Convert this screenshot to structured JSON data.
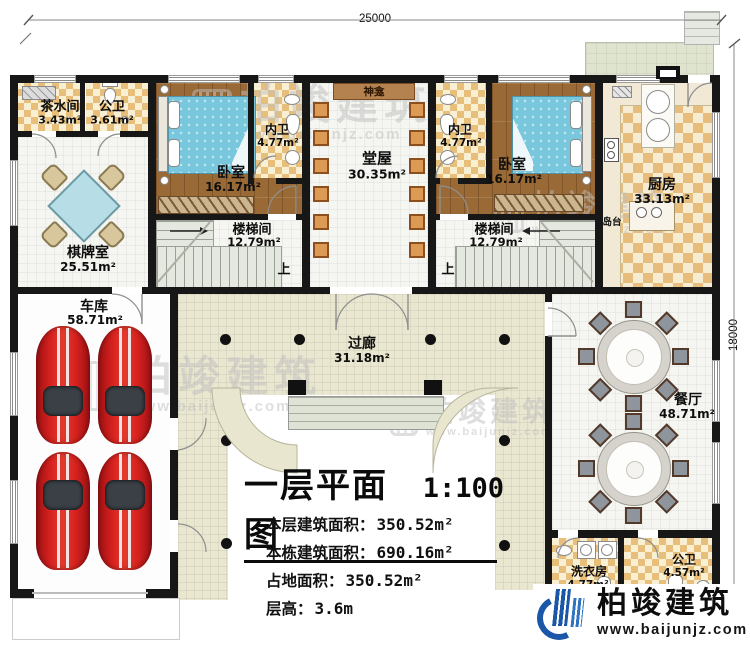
{
  "plan": {
    "dimension_top": "25000",
    "dimension_right": "18000"
  },
  "rooms": {
    "tea": {
      "name": "茶水间",
      "area": "3.43m²"
    },
    "pubwc_top": {
      "name": "公卫",
      "area": "3.61m²"
    },
    "chess": {
      "name": "棋牌室",
      "area": "25.51m²"
    },
    "bed_left": {
      "name": "卧室",
      "area": "16.17m²"
    },
    "bath_left": {
      "name": "内卫",
      "area": "4.77m²"
    },
    "hall": {
      "name": "堂屋",
      "area": "30.35m²"
    },
    "bath_right": {
      "name": "内卫",
      "area": "4.77m²"
    },
    "bed_right": {
      "name": "卧室",
      "area": "16.17m²"
    },
    "kitchen": {
      "name": "厨房",
      "area": "33.13m²"
    },
    "stair_left": {
      "name": "楼梯间",
      "area": "12.79m²"
    },
    "stair_right": {
      "name": "楼梯间",
      "area": "12.79m²"
    },
    "garage": {
      "name": "车库",
      "area": "58.71m²"
    },
    "corridor": {
      "name": "过廊",
      "area": "31.18m²"
    },
    "dining": {
      "name": "餐厅",
      "area": "48.71m²"
    },
    "laundry": {
      "name": "洗衣房",
      "area": "4.77m²"
    },
    "pubwc_bottom": {
      "name": "公卫",
      "area": "4.57m²"
    }
  },
  "annotations": {
    "shrine": "神龛",
    "island": "岛台",
    "stairs_up": "上"
  },
  "title_block": {
    "title": "一层平面图",
    "scale": "1:100",
    "rows": [
      {
        "label": "本层建筑面积：",
        "value": "350.52m²"
      },
      {
        "label": "本栋建筑面积：",
        "value": "690.16m²"
      },
      {
        "label": "占地面积：",
        "value": "350.52m²"
      },
      {
        "label": "层高：",
        "value": "3.6m"
      }
    ]
  },
  "branding": {
    "name": "柏竣建筑",
    "website": "www.baijunjz.com"
  },
  "colors": {
    "wall": "#171717",
    "checker_dark": "#e8bf7a",
    "checker_light": "#f9efd3",
    "wood": "#9a6a36",
    "corridor": "#eae7d0",
    "terrace": "#dfe4cf",
    "logo_blue": "#1a57a8",
    "car_red": "#d8231f",
    "bed_blue": "#79c7dc"
  }
}
